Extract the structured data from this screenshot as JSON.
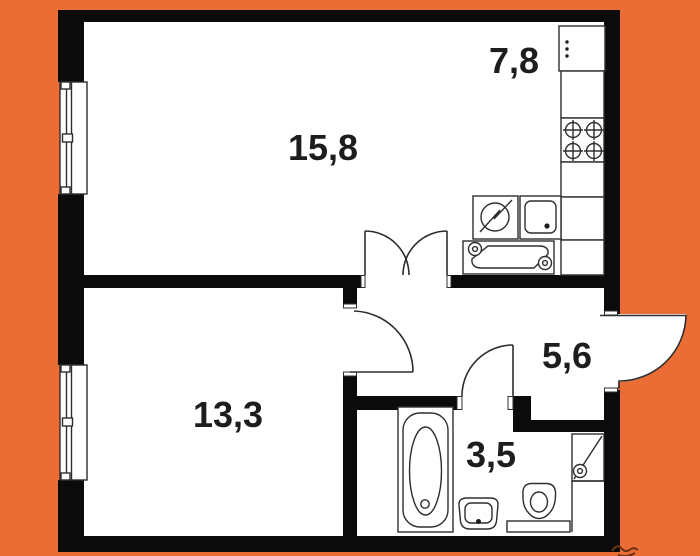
{
  "plan": {
    "background_color": "#EB6D36",
    "wall_color": "#0B0B0B",
    "floor_color": "#FFFFFF",
    "line_color": "#2E2E2E",
    "label_color": "#1D1D1D",
    "signature_color": "#6B3015",
    "rooms": [
      {
        "name": "living-room",
        "area_label": "15,8"
      },
      {
        "name": "kitchen",
        "area_label": "7,8"
      },
      {
        "name": "bedroom",
        "area_label": "13,3"
      },
      {
        "name": "hallway",
        "area_label": "5,6"
      },
      {
        "name": "bathroom",
        "area_label": "3,5"
      }
    ],
    "icons": [
      "window-icon",
      "entrance-door-icon",
      "double-door-icon",
      "bedroom-door-icon",
      "bathroom-door-icon",
      "fridge-icon",
      "stove-burner-icon",
      "kitchen-counter-icon",
      "kitchen-sink-icon",
      "washing-machine-icon",
      "worktop-unit-icon",
      "bathtub-icon",
      "washbasin-icon",
      "toilet-icon",
      "plumbing-shaft-icon"
    ]
  }
}
